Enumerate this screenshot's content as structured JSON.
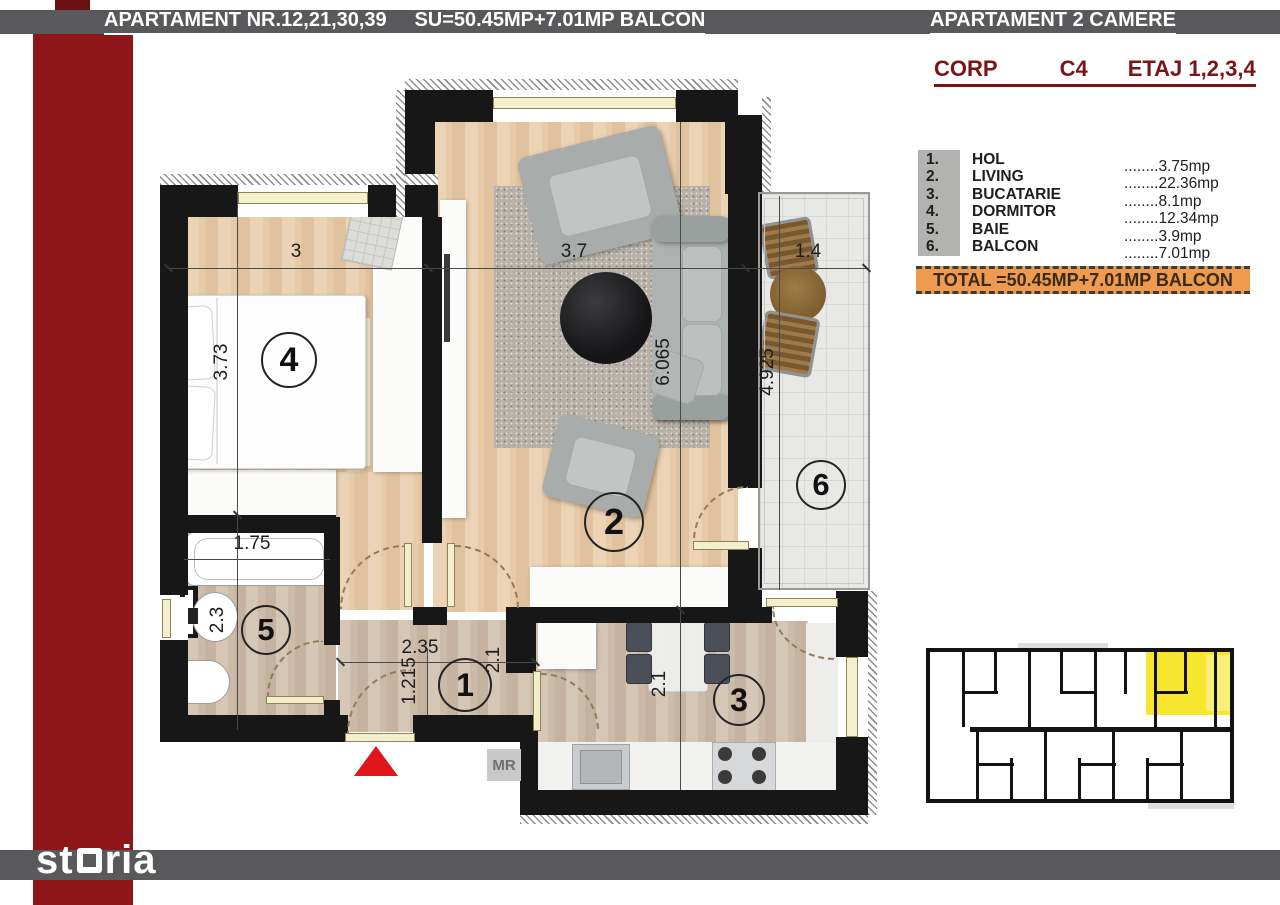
{
  "header": {
    "title_main": "APARTAMENT NR.12,21,30,39     SU=50.45MP+7.01MP BALCON",
    "title_right": "APARTAMENT 2 CAMERE",
    "corp_label": "CORP",
    "corp_value": "C4",
    "etaj_label": "ETAJ 1,2,3,4"
  },
  "legend": {
    "items": [
      {
        "num": "1.",
        "name": "HOL",
        "value": "........3.75mp"
      },
      {
        "num": "2.",
        "name": "LIVING",
        "value": "........22.36mp"
      },
      {
        "num": "3.",
        "name": "BUCATARIE",
        "value": "........8.1mp"
      },
      {
        "num": "4.",
        "name": "DORMITOR",
        "value": "........12.34mp"
      },
      {
        "num": "5.",
        "name": "BAIE",
        "value": "........3.9mp"
      },
      {
        "num": "6.",
        "name": "BALCON",
        "value": "........7.01mp"
      }
    ],
    "total": "TOTAL =50.45MP+7.01MP BALCON"
  },
  "plan": {
    "rooms": {
      "r1": "1",
      "r2": "2",
      "r3": "3",
      "r4": "4",
      "r5": "5",
      "r6": "6"
    },
    "dims": {
      "bedroom_w": "3",
      "living_w": "3.7",
      "balcony_w": "1.4",
      "bedroom_h": "3.73",
      "living_h": "6.065",
      "balcony_h": "4.925",
      "bath_w": "1.75",
      "bath_h": "2.3",
      "hall_w": "2.35",
      "hall_d": "1.215",
      "hall_h": "2.1",
      "kitchen_h": "2.1"
    },
    "mr_label": "MR"
  },
  "footer": {
    "logo_left": "st",
    "logo_right": "ria"
  },
  "colors": {
    "accent_red": "#8e1619",
    "bar_gray": "#59585a",
    "total_orange": "#ee9b50",
    "highlight_yellow": "#f6e62e",
    "entrance_red": "#e2151a"
  }
}
